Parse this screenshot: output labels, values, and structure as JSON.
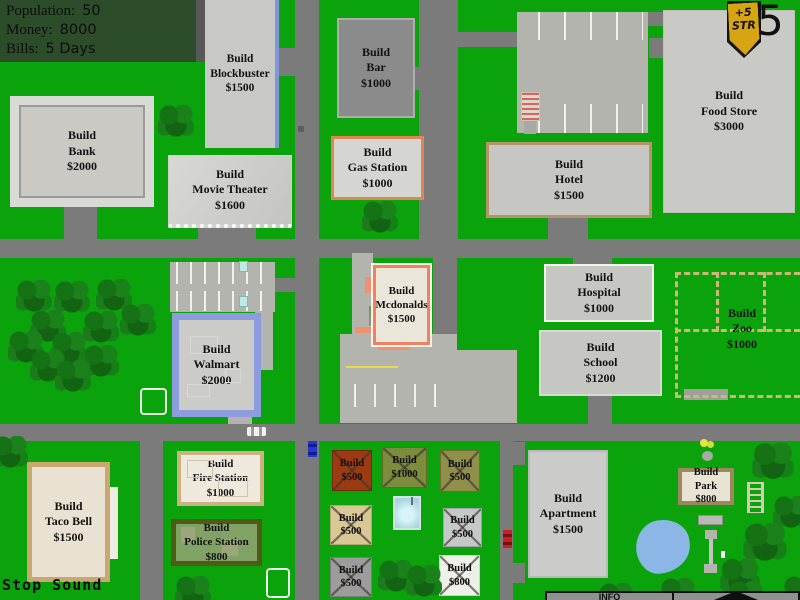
{
  "palette": {
    "grass": "#0aa30c",
    "road": "#7b7b7b",
    "parking": "#b4b4af",
    "hud_panel": "#2c4c2a",
    "badge_gold": "#d7a414",
    "zoo_fence": "#ccb678",
    "water": "#8cb6e6",
    "walmart_blue": "#8d9cdf",
    "mcdonalds_orange": "#ef8262"
  },
  "hud": {
    "stats_panel": {
      "rows": [
        {
          "label": "Population:",
          "value": "50"
        },
        {
          "label": "Money:",
          "value": "8000"
        },
        {
          "label": "Bills:",
          "value": "5 Days"
        }
      ]
    },
    "strength_badge": {
      "top": "+5",
      "bottom": "STR"
    },
    "day_counter": "5",
    "sound_button": "Stop Sound",
    "info_panel": {
      "title": "INFO"
    }
  },
  "build_buttons": {
    "bank": [
      "Build",
      "Bank",
      "$2000"
    ],
    "blockbuster": [
      "Build",
      "Blockbuster",
      "$1500"
    ],
    "movie_theater": [
      "Build",
      "Movie Theater",
      "$1600"
    ],
    "bar": [
      "Build",
      "Bar",
      "$1000"
    ],
    "gas_station": [
      "Build",
      "Gas Station",
      "$1000"
    ],
    "food_store": [
      "Build",
      "Food Store",
      "$3000"
    ],
    "hotel": [
      "Build",
      "Hotel",
      "$1500"
    ],
    "mcdonalds": [
      "Build",
      "Mcdonalds",
      "$1500"
    ],
    "hospital": [
      "Build",
      "Hospital",
      "$1000"
    ],
    "school": [
      "Build",
      "School",
      "$1200"
    ],
    "zoo": [
      "Build",
      "Zoo",
      "$1000"
    ],
    "walmart": [
      "Build",
      "Walmart",
      "$2000"
    ],
    "taco_bell": [
      "Build",
      "Taco Bell",
      "$1500"
    ],
    "fire_station": [
      "Build",
      "Fire Station",
      "$1000"
    ],
    "police_station": [
      "Build",
      "Police Station",
      "$800"
    ],
    "apartment": [
      "Build",
      "Apartment",
      "$1500"
    ],
    "park": [
      "Build",
      "Park",
      "$800"
    ],
    "house_nw": [
      "Build",
      "$500"
    ],
    "house_n": [
      "Build",
      "$1000"
    ],
    "house_ne": [
      "Build",
      "$500"
    ],
    "house_w": [
      "Build",
      "$500"
    ],
    "house_e": [
      "Build",
      "$500"
    ],
    "house_sw": [
      "Build",
      "$500"
    ],
    "house_se": [
      "Build",
      "$800"
    ]
  },
  "map_icons": [
    "tree-icon",
    "pond-icon",
    "pool-icon",
    "white-car-icon",
    "blue-car-icon",
    "red-car-icon",
    "bench-icon",
    "ladder-icon",
    "flower-icon",
    "seesaw-icon",
    "cart-return-icon",
    "fire-escape-icon",
    "manhole-icon",
    "expand-arrow-icon"
  ]
}
